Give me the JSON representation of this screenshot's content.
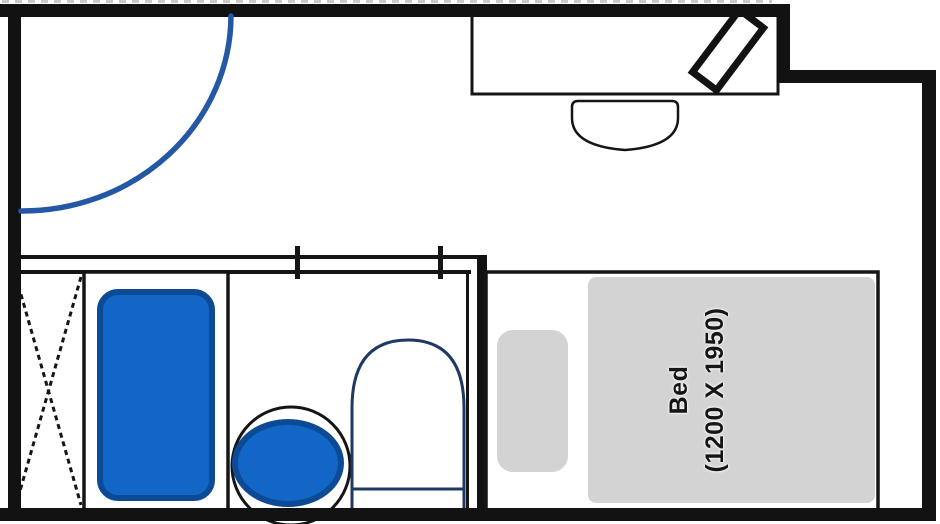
{
  "bed": {
    "label": "Bed",
    "dimensions": "(1200 X 1950)"
  },
  "colors": {
    "wall": "#121212",
    "line": "#151515",
    "fixture_fill": "#1266c6",
    "fixture_stroke": "#0c4a96",
    "outline_navy": "#1f3864",
    "door_arc": "#2458a4",
    "bed_gray": "#d3d3d3",
    "artifact_dash": "#c9c9c9"
  },
  "fixtures": [
    "entry-door-swing",
    "wardrobe",
    "bathtub",
    "washbasin",
    "toilet",
    "desk",
    "desk-chair",
    "tv",
    "pillow",
    "bed"
  ]
}
